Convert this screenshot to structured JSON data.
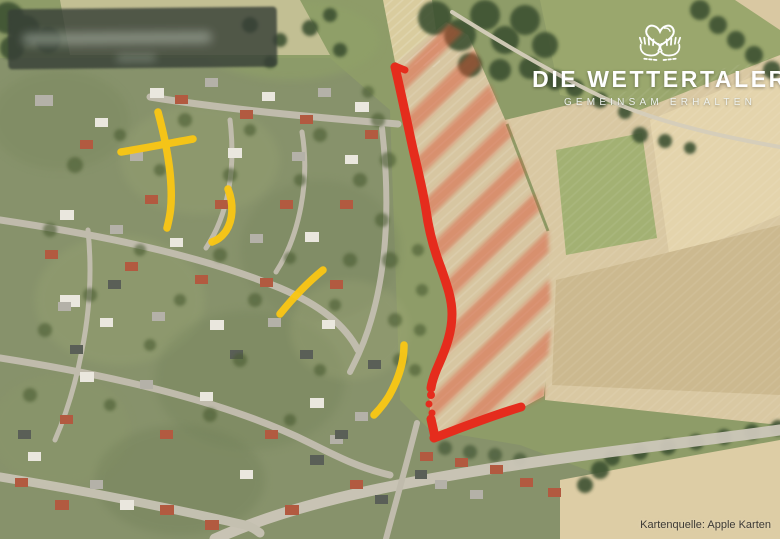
{
  "logo": {
    "icon": "hands-holding-heart-icon",
    "title": "DIE WETTERTALER",
    "subtitle": "GEMEINSAM ERHALTEN"
  },
  "attribution": {
    "label": "Kartenquelle: Apple Karten"
  },
  "map": {
    "type": "satellite-aerial-view",
    "overlays": {
      "boundary_color": "#e52c1d",
      "hatch_color": "#d94f33",
      "street_highlight_color": "#f8c616"
    }
  }
}
